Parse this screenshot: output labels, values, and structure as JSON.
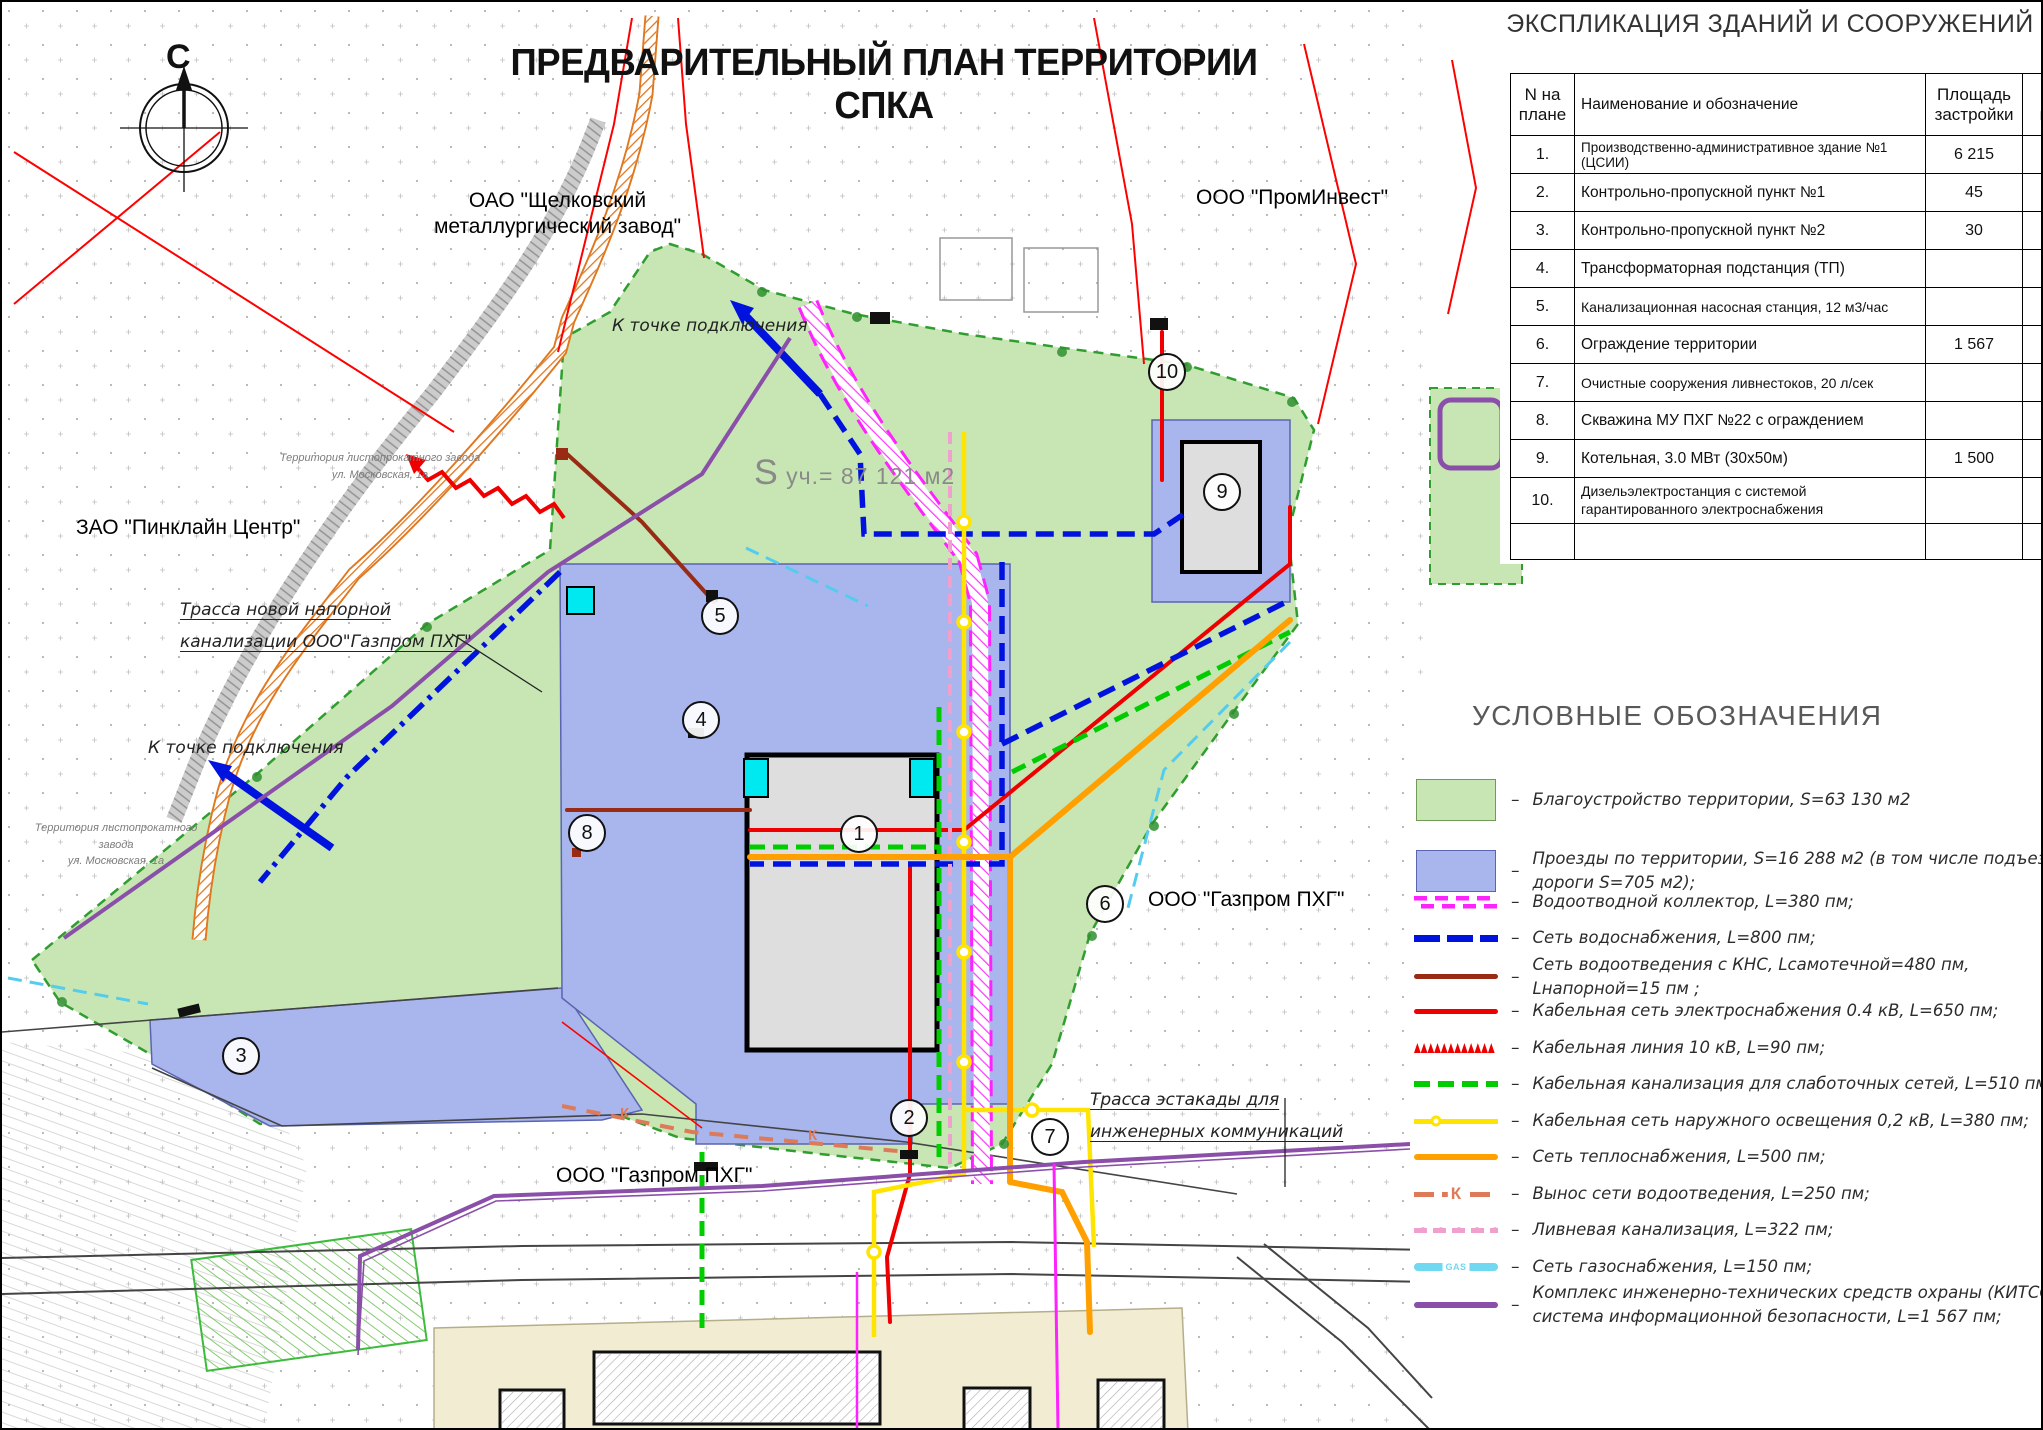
{
  "title": "ПРЕДВАРИТЕЛЬНЫЙ ПЛАН ТЕРРИТОРИИ СПКА",
  "compass": "С",
  "table": {
    "heading": "ЭКСПЛИКАЦИЯ ЗДАНИЙ И СООРУЖЕНИЙ",
    "columns": {
      "num": "N на плане",
      "name": "Наименование и обозначение",
      "area": "Площадь застройки",
      "unit": "Ед. изм."
    },
    "rows": [
      {
        "num": "1.",
        "name": "Производственно-административное здание №1 (ЦСИИ)",
        "area": "6 215",
        "unit": "м2"
      },
      {
        "num": "2.",
        "name": "Контрольно-пропускной пункт №1",
        "area": "45",
        "unit": "м2"
      },
      {
        "num": "3.",
        "name": "Контрольно-пропускной пункт №2",
        "area": "30",
        "unit": "м2"
      },
      {
        "num": "4.",
        "name": "Трансформаторная подстанция (ТП)",
        "area": "",
        "unit": ""
      },
      {
        "num": "5.",
        "name": "Канализационная насосная станция, 12 м3/час",
        "area": "",
        "unit": ""
      },
      {
        "num": "6.",
        "name": "Ограждение территории",
        "area": "1 567",
        "unit": "пм"
      },
      {
        "num": "7.",
        "name": "Очистные сооружения ливнестоков, 20 л/сек",
        "area": "",
        "unit": ""
      },
      {
        "num": "8.",
        "name": "Скважина МУ ПХГ №22 с ограждением",
        "area": "",
        "unit": ""
      },
      {
        "num": "9.",
        "name": "Котельная, 3.0 МВт (30х50м)",
        "area": "1 500",
        "unit": "м2"
      },
      {
        "num": "10.",
        "name": "Дизельэлектростанция с системой гарантированного электроснабжения",
        "area": "",
        "unit": ""
      },
      {
        "num": "",
        "name": "",
        "area": "",
        "unit": ""
      }
    ]
  },
  "legend": {
    "heading": "УСЛОВНЫЕ ОБОЗНАЧЕНИЯ",
    "separator": "–",
    "items": [
      {
        "label": "Благоустройство территории, S=63 130 м2"
      },
      {
        "label": "Проезды по территории, S=16 288 м2 (в том числе подъездные дороги S=705 м2);"
      },
      {
        "label": "Водоотводной коллектор, L=380 пм;"
      },
      {
        "label": "Сеть водоснабжения, L=800 пм;"
      },
      {
        "label": "Сеть водоотведения с КНС, Lсамотечной=480 пм, Lнапорной=15 пм ;"
      },
      {
        "label": "Кабельная сеть электроснабжения 0.4 кВ, L=650 пм;"
      },
      {
        "label": "Кабельная линия 10 кВ, L=90 пм;"
      },
      {
        "label": "Кабельная канализация для слаботочных сетей, L=510 пм;"
      },
      {
        "label": "Кабельная сеть наружного освещения 0,2 кВ, L=380 пм;"
      },
      {
        "label": "Сеть теплоснабжения, L=500 пм;"
      },
      {
        "label": "Вынос сети водоотведения, L=250 пм;",
        "swatch_text": "К"
      },
      {
        "label": "Ливневая канализация, L=322 пм;"
      },
      {
        "label": "Сеть газоснабжения, L=150 пм;",
        "swatch_text": "GAS"
      },
      {
        "label": "Комплекс инженерно-технических средств охраны (КИТСО) и система информационной безопасности, L=1 567 пм;"
      }
    ]
  },
  "map_labels": {
    "oao_schelkovsky": "ОАО \"Щелковский\nметаллургический завод\"",
    "prominvest": "ООО \"ПромИнвест\"",
    "pinkline": "ЗАО \"Пинклайн Центр\"",
    "gazprom_right": "ООО \"Газпром ПХГ\"",
    "gazprom_bottom": "ООО \"Газпром ПХГ\"",
    "trassa_novoy": "Трасса новой напорной\nканализации ООО\"Газпром ПХГ\"",
    "trassa_estakady": "Трасса эстакады для\nинженерных коммуникаций",
    "k_tochke_top": "К точке подключения",
    "k_tochke_left": "К точке подключения",
    "s_uch": "S уч.= 87 121 м2",
    "territory_1": "Территория листопрокатного завода\nул. Московская, 1а",
    "territory_2": "Территория листопрокатного завода\nул. Московская, 1а",
    "k_mark": "К"
  },
  "markers": [
    "1",
    "2",
    "3",
    "4",
    "5",
    "6",
    "7",
    "8",
    "9",
    "10"
  ],
  "colors": {
    "area_green": "#c7e6b4",
    "area_blue": "#a9b6ee",
    "collector_magenta": "#ff22ff",
    "water_blue": "#0012dd",
    "sewer_darkred": "#992b15",
    "power_red": "#ee0000",
    "lowcurrent_green": "#00cc00",
    "light_yellow": "#ffe400",
    "heat_orange": "#ffa000",
    "sewer_out_salmon": "#dd7a5a",
    "storm_pink": "#f0a0cc",
    "gas_cyan": "#70d8f0",
    "kitso_purple": "#8a4fa8",
    "boundary_red": "#ff0000"
  }
}
